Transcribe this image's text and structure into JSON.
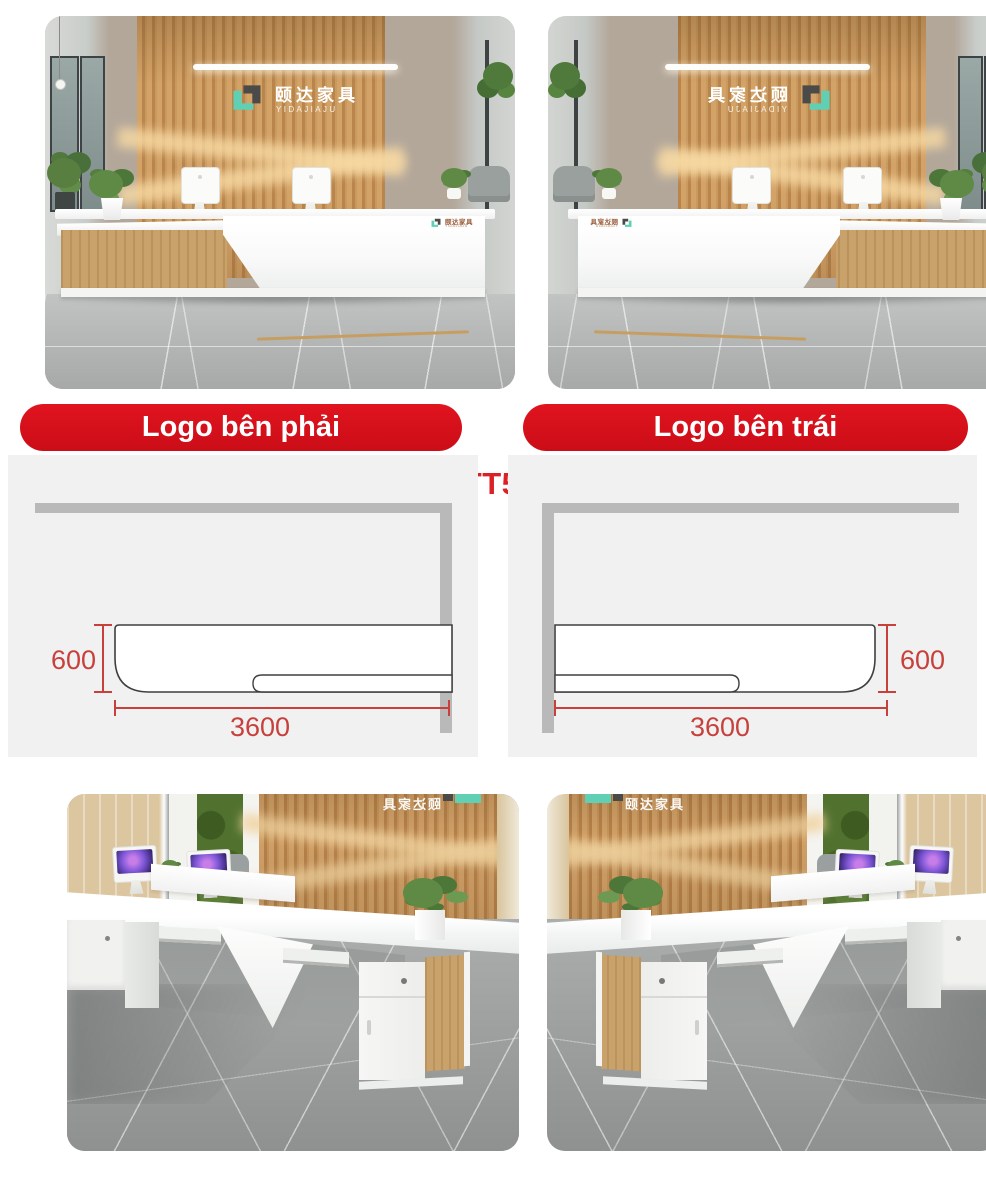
{
  "product_code": "QTT507A",
  "banners": [
    {
      "label": "Logo bên phải"
    },
    {
      "label": "Logo bên trái"
    }
  ],
  "brand": {
    "cn": "颐达家具",
    "en": "YIDAJIAJU"
  },
  "diagrams": {
    "left": {
      "depth": "600",
      "width": "3600"
    },
    "right": {
      "depth": "600",
      "width": "3600"
    }
  },
  "colors": {
    "banner_red": "#d8111b",
    "product_code_red": "#dc2126",
    "dimension_red": "#c8403c",
    "wall_bar_gray": "#b9b9b9",
    "panel_bg": "#f1f1f2",
    "accent_teal": "#5fd0b4",
    "logo_dark": "#4a4a48",
    "wood": "#c89a5f"
  }
}
